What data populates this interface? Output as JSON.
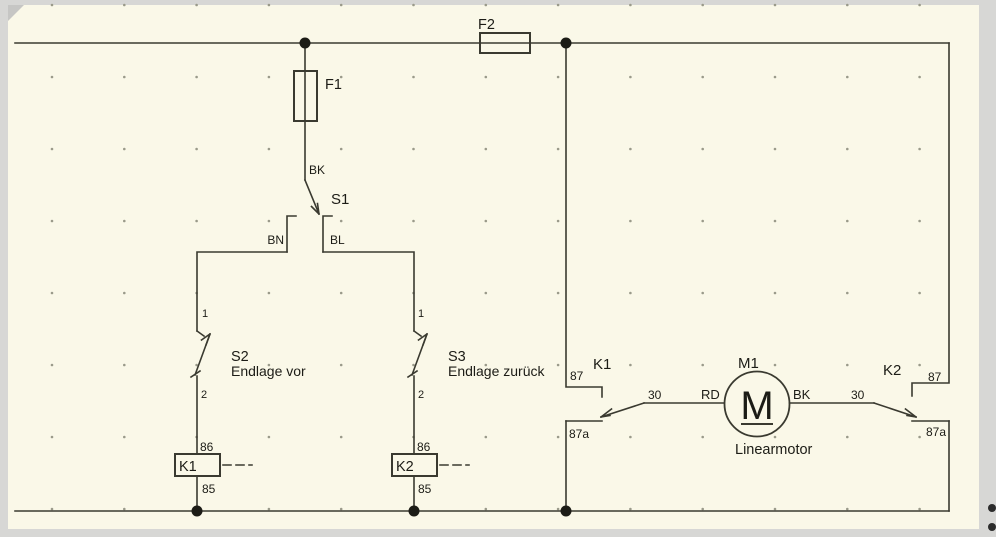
{
  "colors": {
    "frame": "#d7d7d5",
    "canvas": "#faf8e8",
    "line": "#3a3a30",
    "text": "#1c1c16",
    "grid_dot": "#9a9a8a"
  },
  "components": {
    "fuse_f2": {
      "label": "F2"
    },
    "fuse_f1": {
      "label": "F1"
    },
    "switch_s1": {
      "label": "S1",
      "wire_top": "BK",
      "wire_left": "BN",
      "wire_right": "BL"
    },
    "switch_s2": {
      "label": "S2",
      "desc": "Endlage vor",
      "t_top": "1",
      "t_bottom": "2"
    },
    "switch_s3": {
      "label": "S3",
      "desc": "Endlage zurück",
      "t_top": "1",
      "t_bottom": "2"
    },
    "coil_k1": {
      "label": "K1",
      "t_top": "86",
      "t_bottom": "85"
    },
    "coil_k2": {
      "label": "K2",
      "t_top": "86",
      "t_bottom": "85"
    },
    "contact_k1": {
      "label": "K1",
      "t87": "87",
      "t87a": "87a",
      "t30": "30",
      "wire": "RD"
    },
    "contact_k2": {
      "label": "K2",
      "t87": "87",
      "t87a": "87a",
      "t30": "30",
      "wire": "BK"
    },
    "motor_m1": {
      "label": "M1",
      "letter": "M",
      "desc": "Linearmotor"
    }
  }
}
